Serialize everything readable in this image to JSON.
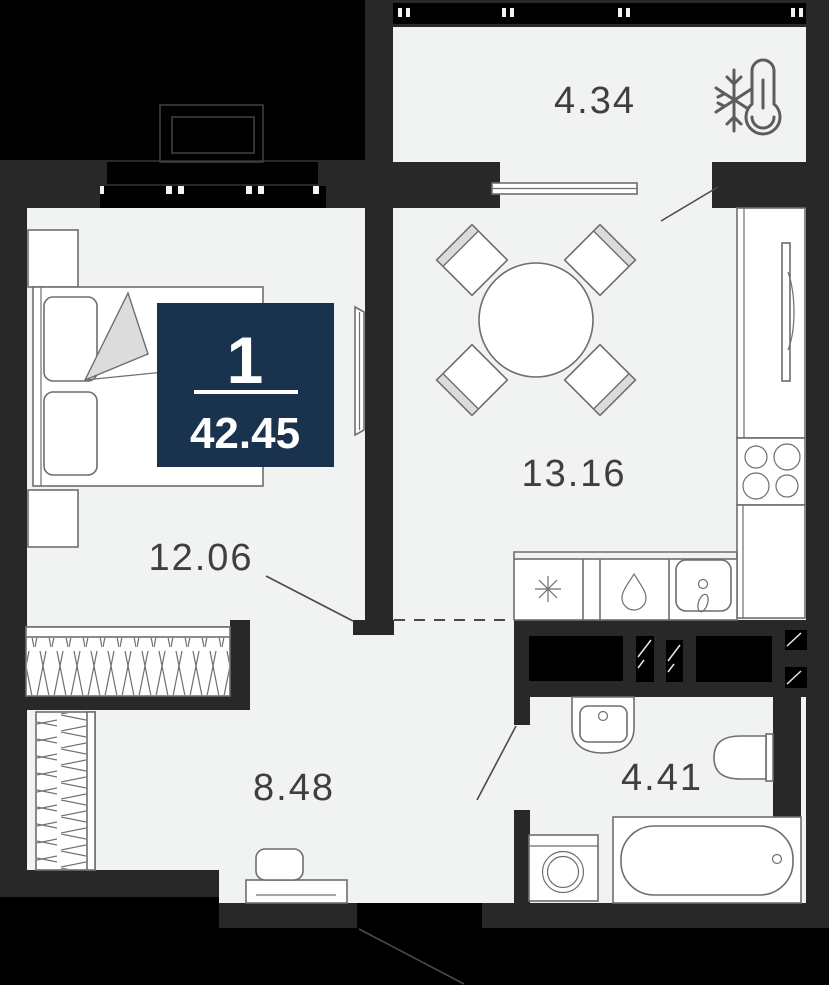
{
  "badge": {
    "rooms_count": "1",
    "total_area": "42.45"
  },
  "rooms": {
    "balcony": {
      "area": "4.34",
      "icon": "thermometer-snowflake-icon"
    },
    "kitchen_living": {
      "area": "13.16"
    },
    "bedroom": {
      "area": "12.06"
    },
    "hallway": {
      "area": "8.48"
    },
    "bathroom": {
      "area": "4.41"
    }
  },
  "colors": {
    "outside": "#000000",
    "wall": "#282828",
    "floor": "#f1f2f2",
    "furniture_fill": "#ffffff",
    "furniture_stroke": "#6e6e6e",
    "accent_navy": "#19324e",
    "label_text": "#3f3f3f",
    "soft_fill": "#dcdcdc"
  }
}
